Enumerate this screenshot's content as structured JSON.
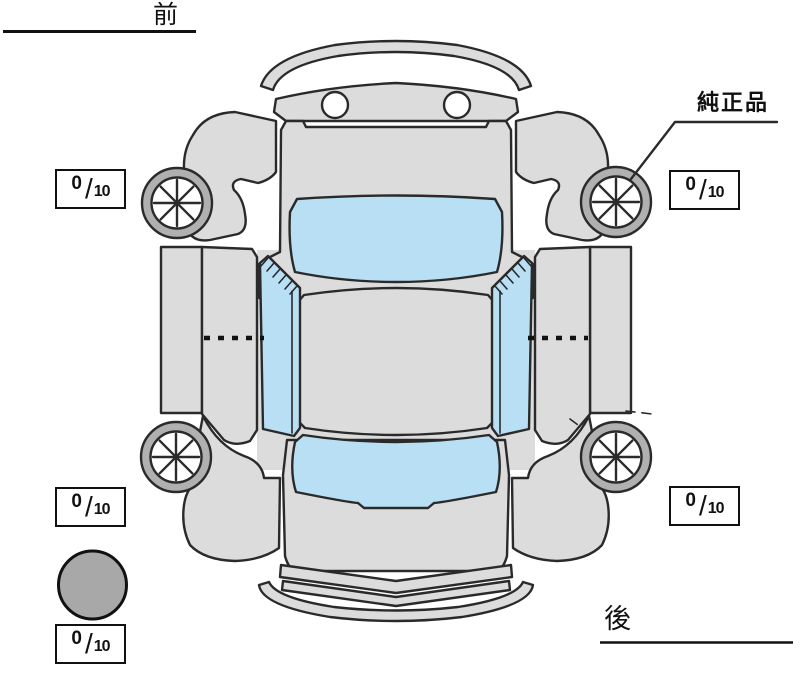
{
  "labels": {
    "front": "前",
    "rear": "後",
    "genuine_part": "純正品"
  },
  "tread_scores": {
    "front_left": {
      "value": "0",
      "slash": "/",
      "max": "10"
    },
    "front_right": {
      "value": "0",
      "slash": "/",
      "max": "10"
    },
    "rear_left": {
      "value": "0",
      "slash": "/",
      "max": "10"
    },
    "rear_right": {
      "value": "0",
      "slash": "/",
      "max": "10"
    },
    "spare": {
      "value": "0",
      "slash": "/",
      "max": "10"
    }
  },
  "colors": {
    "background": "#ffffff",
    "body": "#dcdcdc",
    "glass": "#b9dff5",
    "tire_ring": "#b0b0b0",
    "rim": "#ffffff",
    "spare_tire": "#a8a8a8",
    "outline": "#2a2a2a",
    "box_border": "#111111"
  }
}
